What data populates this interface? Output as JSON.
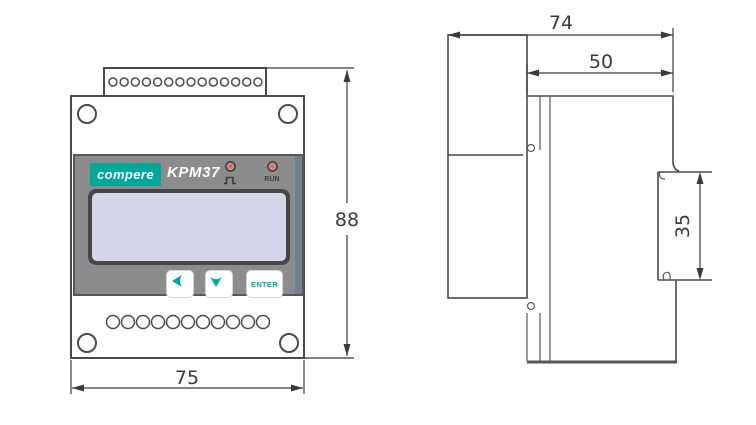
{
  "front_view": {
    "brand": "compere",
    "model": "KPM37",
    "led_pulse": {
      "name": "pulse-indicator"
    },
    "led_run": {
      "label": "RUN"
    },
    "buttons": {
      "enter": "ENTER"
    },
    "terminals_top": 14,
    "terminals_bottom": 11,
    "dim_height": "88",
    "dim_width": "75"
  },
  "side_view": {
    "dim_depth_total": "74",
    "dim_depth_rear": "50",
    "dim_rail": "35"
  },
  "colors": {
    "accent_teal": "#00a79b",
    "panel_gray": "#8c8c8c",
    "lcd_lavender": "#d6d6e8",
    "line_gray": "#4a4a4a",
    "led_pink": "#eba8a8",
    "panel_bevel_blue": "#6d8193"
  }
}
